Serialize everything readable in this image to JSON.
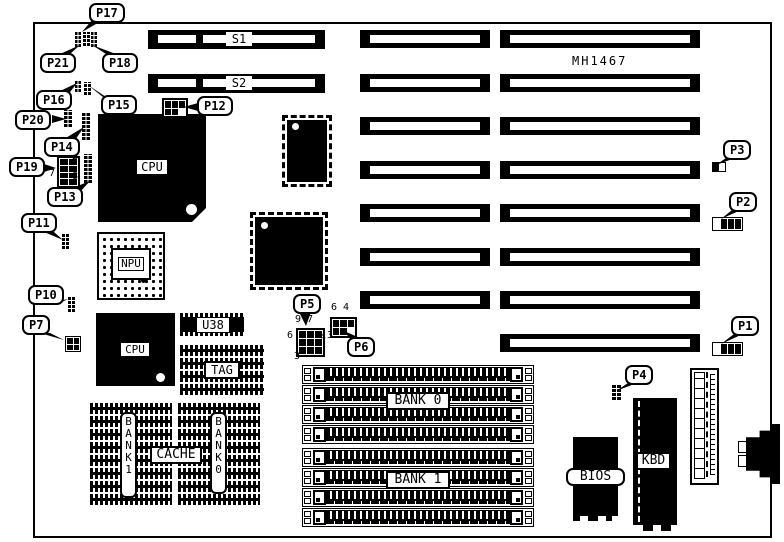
{
  "board": {
    "model": "MH1467"
  },
  "callouts": {
    "p1": "P1",
    "p2": "P2",
    "p3": "P3",
    "p4": "P4",
    "p5": "P5",
    "p6": "P6",
    "p7": "P7",
    "p10": "P10",
    "p11": "P11",
    "p12": "P12",
    "p13": "P13",
    "p14": "P14",
    "p15": "P15",
    "p16": "P16",
    "p17": "P17",
    "p18": "P18",
    "p19": "P19",
    "p20": "P20",
    "p21": "P21"
  },
  "slots": {
    "s1": "S1",
    "s2": "S2"
  },
  "chips": {
    "cpu1": "CPU",
    "npu": "NPU",
    "cpu2": "CPU",
    "u38": "U38",
    "tag": "TAG",
    "cache": "CACHE",
    "cache_bank1": "BANK 1",
    "cache_bank0": "BANK 0",
    "simm_bank0": "BANK 0",
    "simm_bank1": "BANK 1",
    "bios": "BIOS",
    "kbd": "KBD"
  },
  "pin_numbers": {
    "p19_pin2": "2",
    "p19_pin7": "7",
    "p19_pin8": "8",
    "p5_pin9": "9",
    "p5_pin7": "7",
    "p5_pin6": "6",
    "p5_pin4": "4",
    "p5_pin3": "3",
    "p6_pin6": "6",
    "p6_pin4": "4",
    "p6_pin3": "3"
  }
}
